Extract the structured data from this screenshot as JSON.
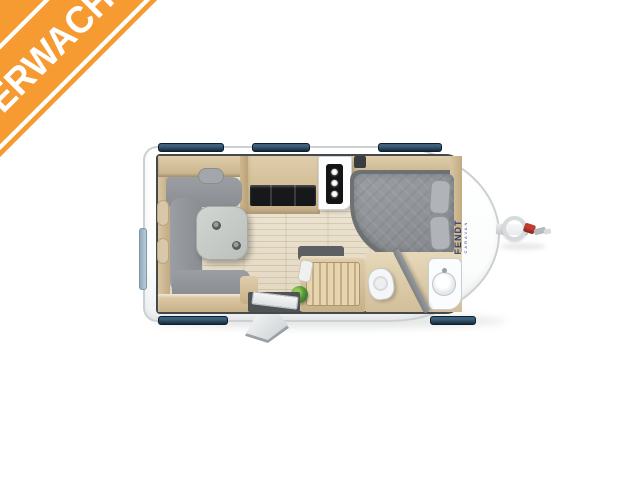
{
  "banner": {
    "label": "VERWACHT",
    "bg_color": "#F59B32",
    "stripe_color": "#FFFFFF",
    "text_color": "#FFFFFF"
  },
  "brand_badge": {
    "name": "FENDT",
    "sub": "CARAVAN",
    "color": "#2B3F72"
  },
  "floorplan": {
    "type": "caravan-top-view-floor-plan",
    "features": [
      "u-shaped-lounge-sofa",
      "dining-table-with-cups",
      "kitchen-counter-with-cooktop",
      "stove-knob-panel",
      "double-bed-with-pillows",
      "wardrobe",
      "sideboard-bench",
      "green-plant",
      "entry-door-with-step",
      "bathroom",
      "toilet",
      "wash-basin",
      "shower-partition",
      "roof-windows",
      "rear-window",
      "tow-hitch",
      "jockey-wheel"
    ],
    "colors": {
      "body": "#FFFFFF",
      "window_glass": "#2A4A63",
      "wood": "#D5C19C",
      "sofa_gray": "#94979B",
      "mattress_gray": "#8F9397",
      "floor": "#EAE2CF",
      "plant_green": "#54963A",
      "hitch_red": "#C33D2E",
      "cooktop_black": "#1C1D1F"
    }
  }
}
